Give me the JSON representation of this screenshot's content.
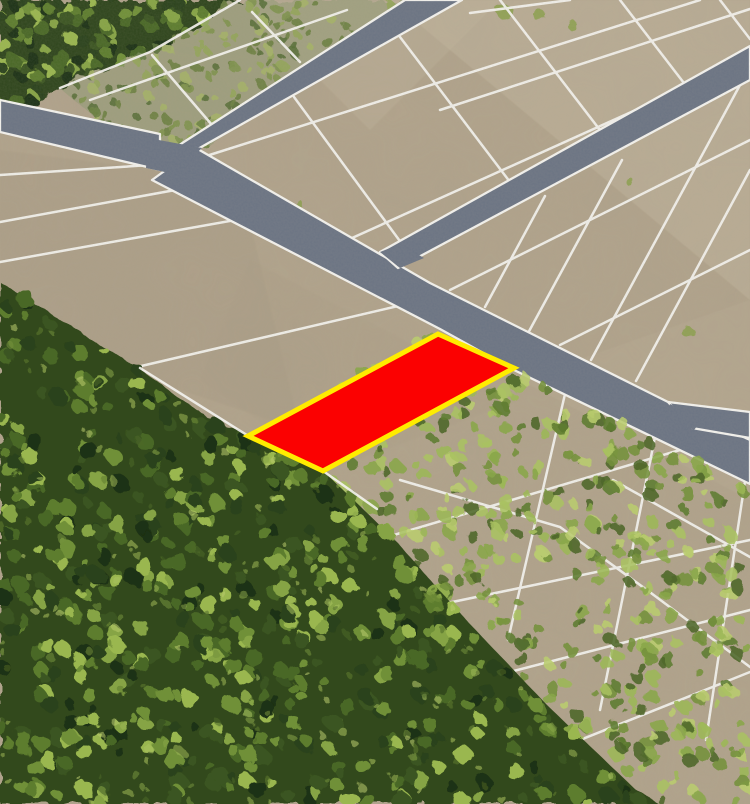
{
  "scene": {
    "name": "aerial-parcel-map",
    "width": 750,
    "height": 804,
    "description": "oblique aerial photo of subdivided land with one highlighted parcel"
  },
  "colors": {
    "field_base": "#b2a48c",
    "field_light": "#cabfa7",
    "field_mid_light": "#c5b9a2",
    "field_shadow": "#a2957f",
    "road_gray": "#6b7484",
    "line_white": "#f4f3ef",
    "parcel_red": "#fb0101",
    "parcel_yellow_border": "#ffec00",
    "forest_dense_base": "#33491c",
    "forest_top_base": "#2f451b",
    "scrub_wash": "#8e9a6f",
    "palette_dense": [
      "#2c431a",
      "#3a5520",
      "#4a6826",
      "#5d7d2e",
      "#6f9038",
      "#86a444",
      "#9ab74f",
      "#1e3012"
    ],
    "palette_light": [
      "#5f7c30",
      "#74913c",
      "#89a649",
      "#9cb755",
      "#aac261",
      "#b9cc6e",
      "#4d672a"
    ],
    "palette_scrub": [
      "#6d8243",
      "#7f944e",
      "#93a65a",
      "#a5b468",
      "#59713a"
    ]
  },
  "tone_patches": [
    {
      "name": "tone-upper-right",
      "points": [
        [
          390,
          0
        ],
        [
          750,
          0
        ],
        [
          750,
          300
        ]
      ],
      "fill": "#cabfa7",
      "opacity": 0.33
    },
    {
      "name": "tone-top-center",
      "points": [
        [
          240,
          0
        ],
        [
          500,
          0
        ],
        [
          370,
          130
        ]
      ],
      "fill": "#c5b9a2",
      "opacity": 0.28
    },
    {
      "name": "tone-left-mid",
      "points": [
        [
          0,
          150
        ],
        [
          240,
          180
        ],
        [
          300,
          430
        ],
        [
          0,
          330
        ]
      ],
      "fill": "#a2957f",
      "opacity": 0.22
    },
    {
      "name": "tone-center",
      "points": [
        [
          250,
          260
        ],
        [
          520,
          400
        ],
        [
          330,
          470
        ],
        [
          200,
          380
        ]
      ],
      "fill": "#aa9d86",
      "opacity": 0.25
    },
    {
      "name": "tone-right-low",
      "points": [
        [
          520,
          380
        ],
        [
          750,
          500
        ],
        [
          750,
          300
        ]
      ],
      "fill": "#c0b49c",
      "opacity": 0.2
    }
  ],
  "parcel_lines": [
    {
      "name": "forest-edge-line",
      "points": [
        [
          240,
          0
        ],
        [
          150,
          52
        ],
        [
          60,
          88
        ]
      ]
    },
    {
      "name": "strip-row",
      "points": [
        [
          90,
          100
        ],
        [
          347,
          10
        ]
      ]
    },
    {
      "name": "strip-col-1",
      "points": [
        [
          152,
          55
        ],
        [
          212,
          125
        ]
      ]
    },
    {
      "name": "strip-col-2",
      "points": [
        [
          252,
          12
        ],
        [
          300,
          62
        ]
      ]
    },
    {
      "name": "left-row-1",
      "points": [
        [
          0,
          175
        ],
        [
          150,
          165
        ]
      ]
    },
    {
      "name": "left-row-2",
      "points": [
        [
          0,
          222
        ],
        [
          230,
          180
        ]
      ]
    },
    {
      "name": "left-row-3",
      "points": [
        [
          0,
          262
        ],
        [
          280,
          212
        ]
      ]
    },
    {
      "name": "left-row-4",
      "points": [
        [
          137,
          367
        ],
        [
          398,
          306
        ]
      ]
    },
    {
      "name": "upper-row-1",
      "points": [
        [
          200,
          158
        ],
        [
          700,
          0
        ]
      ]
    },
    {
      "name": "upper-row-2",
      "points": [
        [
          440,
          110
        ],
        [
          750,
          9
        ]
      ]
    },
    {
      "name": "upper-row-3",
      "points": [
        [
          470,
          13
        ],
        [
          570,
          0
        ]
      ]
    },
    {
      "name": "upper-row-4",
      "points": [
        [
          352,
          238
        ],
        [
          700,
          81
        ]
      ]
    },
    {
      "name": "upper-col-1",
      "points": [
        [
          294,
          97
        ],
        [
          405,
          248
        ]
      ]
    },
    {
      "name": "upper-col-2",
      "points": [
        [
          400,
          37
        ],
        [
          513,
          186
        ]
      ]
    },
    {
      "name": "upper-col-3",
      "points": [
        [
          500,
          0
        ],
        [
          603,
          134
        ]
      ]
    },
    {
      "name": "upper-col-4",
      "points": [
        [
          620,
          0
        ],
        [
          687,
          87
        ]
      ]
    },
    {
      "name": "upper-col-5",
      "points": [
        [
          720,
          0
        ],
        [
          750,
          39
        ]
      ]
    },
    {
      "name": "wedge-row-1",
      "points": [
        [
          450,
          290
        ],
        [
          750,
          140
        ]
      ]
    },
    {
      "name": "wedge-row-2",
      "points": [
        [
          560,
          345
        ],
        [
          750,
          250
        ]
      ]
    },
    {
      "name": "wedge-col-1",
      "points": [
        [
          545,
          196
        ],
        [
          485,
          307
        ]
      ]
    },
    {
      "name": "wedge-col-2",
      "points": [
        [
          622,
          160
        ],
        [
          527,
          335
        ]
      ]
    },
    {
      "name": "wedge-col-3",
      "points": [
        [
          740,
          85
        ],
        [
          591,
          360
        ]
      ]
    },
    {
      "name": "wedge-col-4",
      "points": [
        [
          750,
          170
        ],
        [
          636,
          381
        ]
      ]
    },
    {
      "name": "red-row-bottom",
      "points": [
        [
          295,
          487
        ],
        [
          514,
          368
        ]
      ]
    },
    {
      "name": "low-row-1",
      "points": [
        [
          360,
          545
        ],
        [
          680,
          450
        ]
      ]
    },
    {
      "name": "low-row-2",
      "points": [
        [
          390,
          615
        ],
        [
          750,
          540
        ]
      ]
    },
    {
      "name": "low-row-3",
      "points": [
        [
          440,
          690
        ],
        [
          750,
          610
        ]
      ]
    },
    {
      "name": "low-row-4",
      "points": [
        [
          505,
          770
        ],
        [
          750,
          672
        ]
      ]
    },
    {
      "name": "low-col-1",
      "points": [
        [
          565,
          394
        ],
        [
          508,
          640
        ]
      ]
    },
    {
      "name": "low-col-2",
      "points": [
        [
          655,
          437
        ],
        [
          600,
          710
        ]
      ]
    },
    {
      "name": "low-col-3",
      "points": [
        [
          745,
          481
        ],
        [
          706,
          740
        ]
      ]
    },
    {
      "name": "low-strip-1",
      "points": [
        [
          400,
          480
        ],
        [
          560,
          527
        ],
        [
          647,
          590
        ],
        [
          750,
          667
        ]
      ]
    },
    {
      "name": "low-strip-2",
      "points": [
        [
          613,
          480
        ],
        [
          750,
          557
        ]
      ]
    }
  ],
  "roads": [
    {
      "name": "road-west-stub",
      "points": [
        [
          0,
          100
        ],
        [
          160,
          134
        ],
        [
          160,
          170
        ],
        [
          0,
          132
        ]
      ]
    },
    {
      "name": "road-north",
      "points": [
        [
          405,
          0
        ],
        [
          462,
          0
        ],
        [
          196,
          150
        ],
        [
          148,
          165
        ]
      ]
    },
    {
      "name": "road-main-diagonal",
      "points": [
        [
          196,
          148
        ],
        [
          430,
          283
        ],
        [
          680,
          408
        ],
        [
          750,
          440
        ],
        [
          750,
          484
        ],
        [
          514,
          370
        ],
        [
          440,
          329
        ],
        [
          152,
          180
        ]
      ]
    },
    {
      "name": "road-branch-east",
      "points": [
        [
          668,
          402
        ],
        [
          750,
          412
        ],
        [
          750,
          438
        ],
        [
          692,
          428
        ]
      ]
    },
    {
      "name": "road-northeast",
      "points": [
        [
          750,
          46
        ],
        [
          750,
          80
        ],
        [
          398,
          268
        ],
        [
          380,
          252
        ]
      ]
    }
  ],
  "junction_patches": [
    {
      "name": "junction-west",
      "points": [
        [
          148,
          138
        ],
        [
          202,
          148
        ],
        [
          174,
          174
        ],
        [
          146,
          168
        ]
      ]
    },
    {
      "name": "junction-center",
      "points": [
        [
          380,
          252
        ],
        [
          400,
          268
        ],
        [
          424,
          258
        ],
        [
          400,
          244
        ]
      ]
    },
    {
      "name": "junction-east",
      "points": [
        [
          670,
          404
        ],
        [
          702,
          420
        ],
        [
          694,
          430
        ],
        [
          666,
          418
        ]
      ]
    }
  ],
  "forest_regions": [
    {
      "name": "forest-top-left",
      "base": "#2f451b",
      "baseOpacity": 1,
      "points": [
        [
          0,
          0
        ],
        [
          240,
          0
        ],
        [
          150,
          52
        ],
        [
          60,
          88
        ],
        [
          0,
          117
        ]
      ],
      "blobs": {
        "count": 110,
        "rmin": 4,
        "rmax": 8,
        "palette": "palette_dense",
        "opacity": 1,
        "seed": 11
      }
    },
    {
      "name": "scrub-strip-topleft",
      "base": "#8e9a6f",
      "baseOpacity": 0.5,
      "points": [
        [
          240,
          0
        ],
        [
          420,
          0
        ],
        [
          300,
          75
        ],
        [
          196,
          150
        ],
        [
          150,
          164
        ],
        [
          60,
          88
        ],
        [
          150,
          52
        ]
      ],
      "blobs": {
        "count": 160,
        "rmin": 2.5,
        "rmax": 5.5,
        "palette": "palette_scrub",
        "opacity": 0.9,
        "seed": 21
      }
    }
  ],
  "overgrown_region": {
    "name": "forest-overgrown-lower-right",
    "base": null,
    "points": [
      [
        250,
        437
      ],
      [
        323,
        471
      ],
      [
        362,
        508
      ],
      [
        432,
        582
      ],
      [
        508,
        664
      ],
      [
        592,
        748
      ],
      [
        660,
        804
      ],
      [
        750,
        804
      ],
      [
        750,
        486
      ],
      [
        518,
        372
      ],
      [
        440,
        331
      ]
    ],
    "blobs": {
      "count": 470,
      "rmin": 3.5,
      "rmax": 7.5,
      "palette": "palette_light",
      "opacity": 0.88,
      "seed": 31
    }
  },
  "dense_forest_region": {
    "name": "forest-dense-bottom-left",
    "base": "#33491c",
    "baseOpacity": 1,
    "points": [
      [
        0,
        282
      ],
      [
        77,
        330
      ],
      [
        137,
        367
      ],
      [
        200,
        413
      ],
      [
        248,
        436
      ],
      [
        285,
        453
      ],
      [
        323,
        471
      ],
      [
        362,
        508
      ],
      [
        398,
        543
      ],
      [
        432,
        582
      ],
      [
        470,
        624
      ],
      [
        508,
        664
      ],
      [
        548,
        706
      ],
      [
        592,
        748
      ],
      [
        636,
        790
      ],
      [
        660,
        804
      ],
      [
        0,
        804
      ]
    ],
    "blobs": {
      "count": 560,
      "rmin": 4,
      "rmax": 9,
      "palette": "palette_dense",
      "opacity": 1,
      "seed": 41
    },
    "highlights": {
      "count": 200,
      "rmin": 2,
      "rmax": 4.5,
      "palette": "palette_light",
      "opacity": 0.55,
      "seed": 42
    }
  },
  "small_scrub_patches": [
    {
      "cx": 505,
      "cy": 12,
      "r": 8
    },
    {
      "cx": 540,
      "cy": 16,
      "r": 6
    },
    {
      "cx": 575,
      "cy": 28,
      "r": 5
    },
    {
      "cx": 688,
      "cy": 332,
      "r": 6
    },
    {
      "cx": 628,
      "cy": 180,
      "r": 4
    },
    {
      "cx": 300,
      "cy": 205,
      "r": 4
    }
  ],
  "post_forest_lines": [
    {
      "name": "forest-boundary-white-line",
      "points": [
        [
          140,
          368
        ],
        [
          250,
          437
        ]
      ]
    },
    {
      "name": "overgrown-stub-line",
      "points": [
        [
          323,
          471
        ],
        [
          377,
          509
        ]
      ]
    }
  ],
  "highlighted_parcel": {
    "name": "highlighted-parcel",
    "corners": [
      [
        248,
        436
      ],
      [
        438,
        334
      ],
      [
        514,
        368
      ],
      [
        323,
        471
      ]
    ],
    "fill": "#fb0101",
    "border": "#ffec00",
    "border_width": 5
  },
  "line_style": {
    "width": 2.5,
    "opacity": 0.95
  },
  "road_style": {
    "outline_width": 2.3
  }
}
